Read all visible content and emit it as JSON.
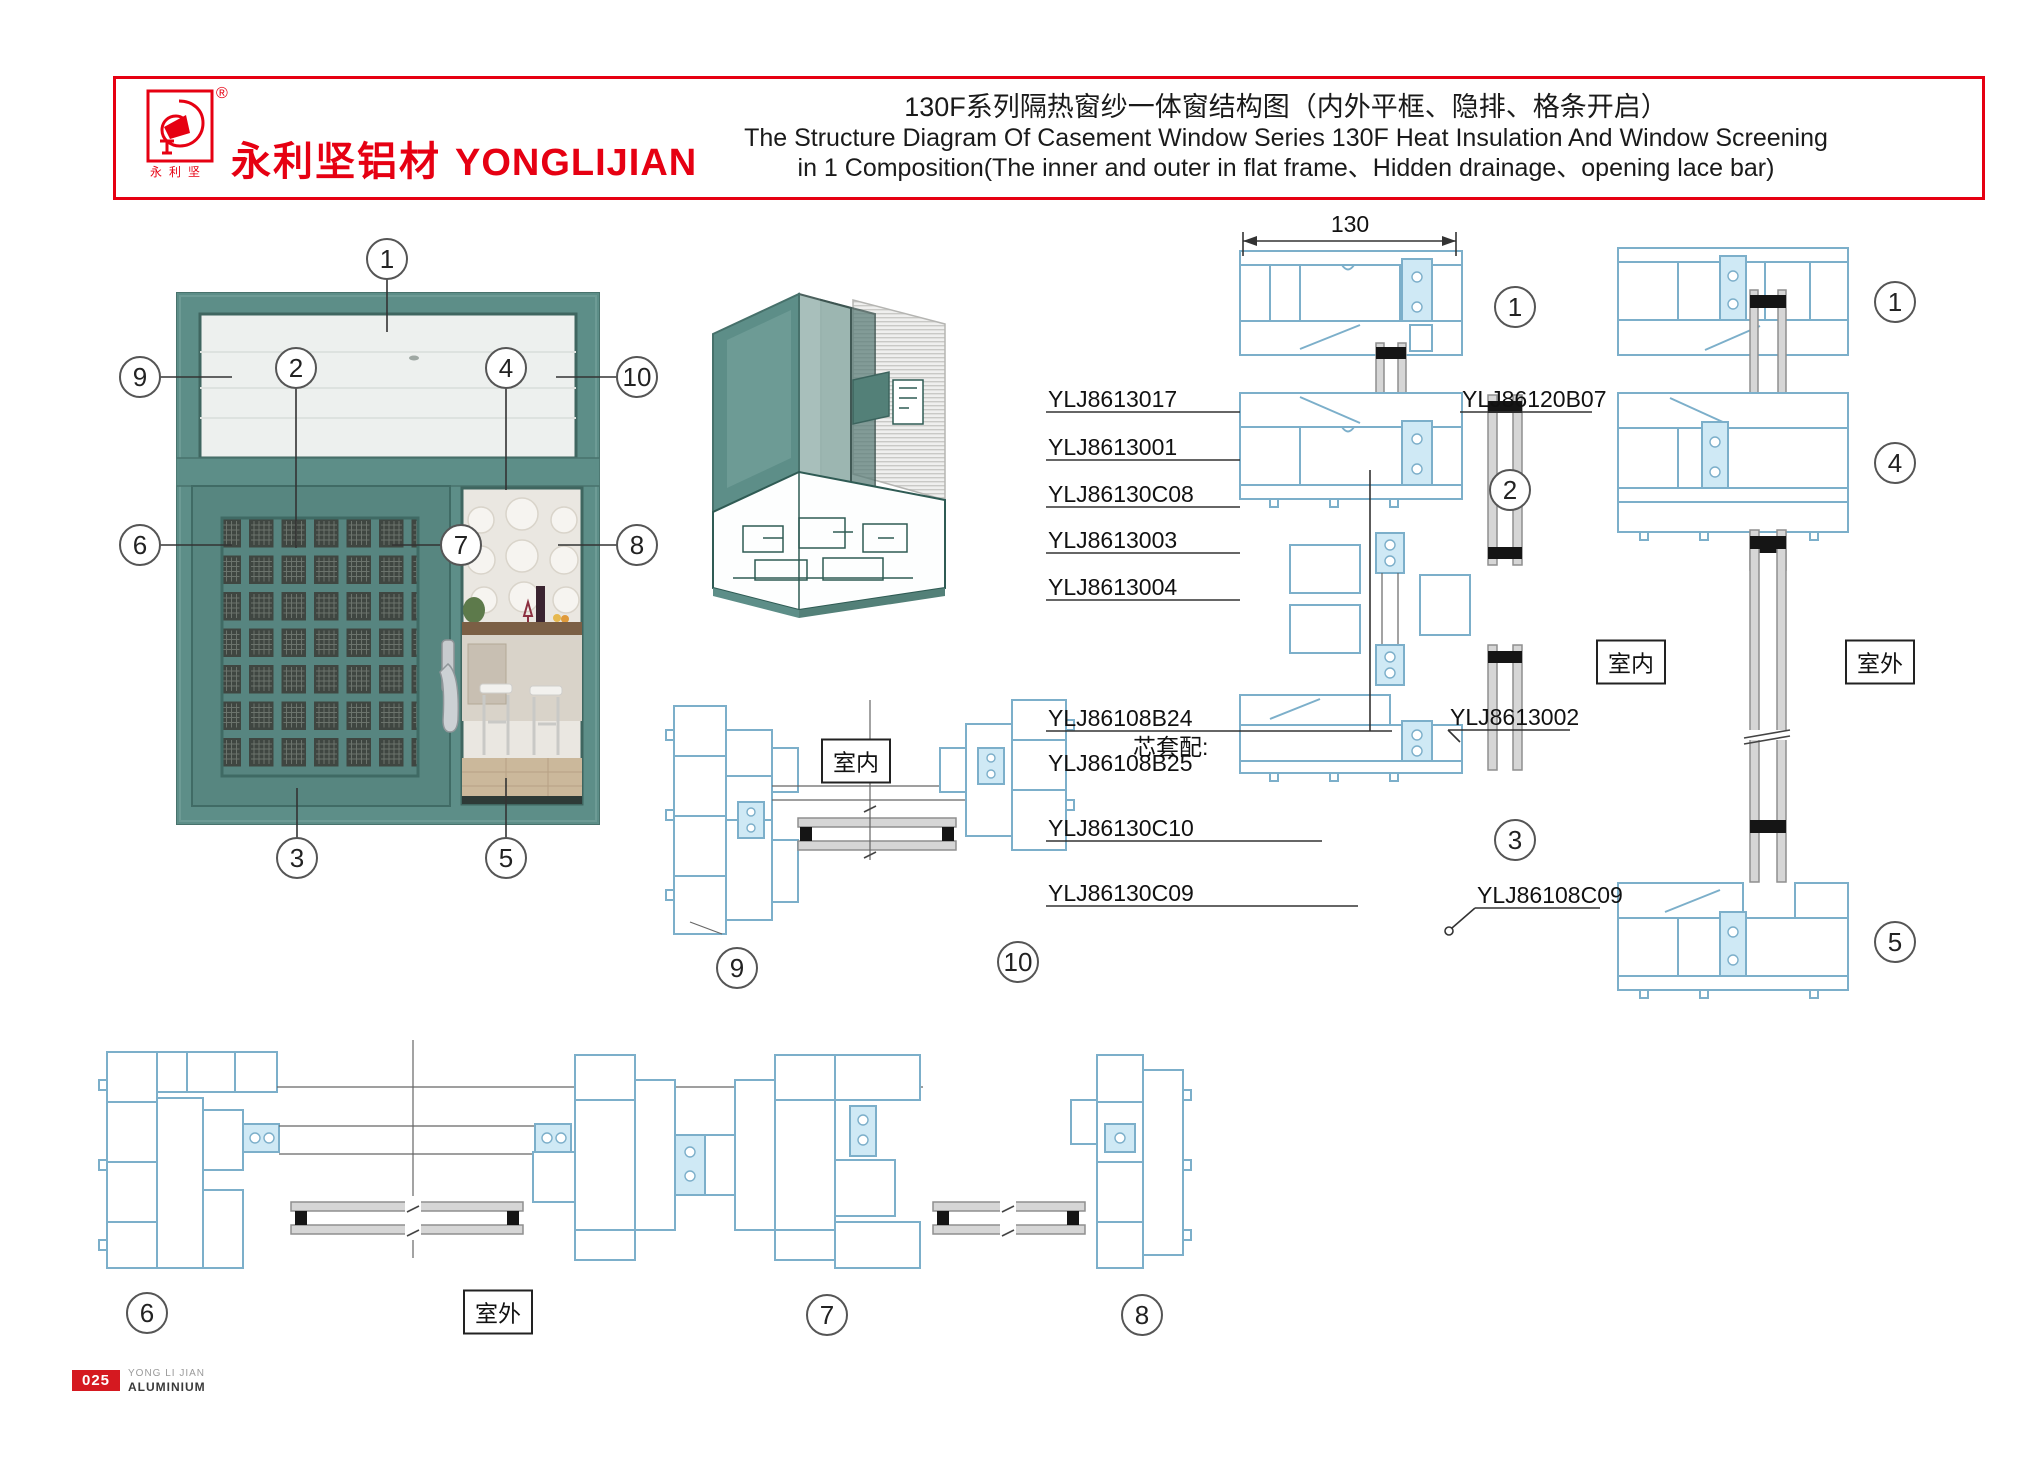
{
  "header": {
    "registered_mark": "®",
    "logo_seal": "永利坚",
    "brand_cn": "永利坚铝材",
    "brand_en": "YONGLIJIAN",
    "title_cn": "130F系列隔热窗纱一体窗结构图（内外平框、隐排、格条开启）",
    "title_en1": "The Structure Diagram Of Casement Window Series 130F Heat Insulation And Window Screening",
    "title_en2": "in 1 Composition(The inner and outer in flat frame、Hidden drainage、opening lace bar)",
    "accent_color": "#e60012"
  },
  "diagram": {
    "dimension_width": "130",
    "indoor_label": "室内",
    "outdoor_label": "室外"
  },
  "callout_numbers": {
    "n1": "1",
    "n2": "2",
    "n3": "3",
    "n4": "4",
    "n5": "5",
    "n6": "6",
    "n7": "7",
    "n8": "8",
    "n9": "9",
    "n10": "10"
  },
  "parts": {
    "left": [
      "YLJ8613017",
      "YLJ8613001",
      "YLJ86130C08",
      "YLJ8613003",
      "YLJ8613004"
    ],
    "screen_group": {
      "main": "YLJ86108B24",
      "note": "芯套配:",
      "core": "YLJ86108B25"
    },
    "left_lower": [
      "YLJ86130C10",
      "YLJ86130C09"
    ],
    "right": [
      "YLJ86120B07",
      "YLJ8613002",
      "YLJ86108C09"
    ]
  },
  "footer": {
    "page_number": "025",
    "brand_top": "YONG LI JIAN",
    "brand_bottom": "ALUMINIUM"
  }
}
